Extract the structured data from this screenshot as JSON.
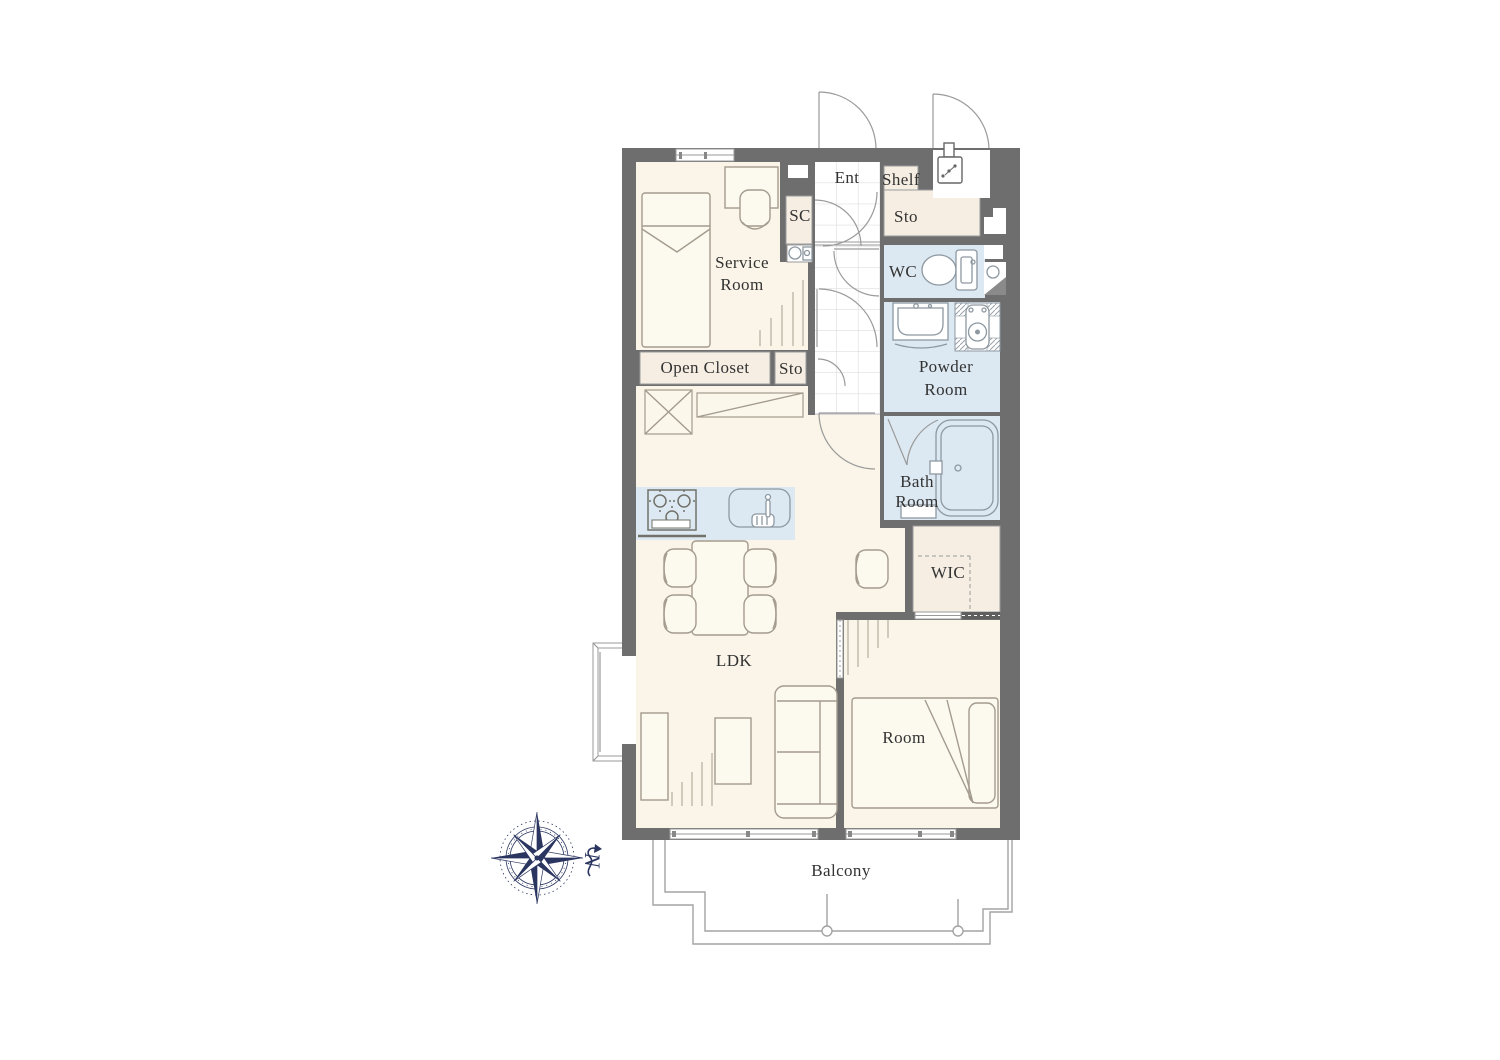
{
  "plan": {
    "labels": {
      "ent": "Ent",
      "shelf": "Shelf",
      "sto_upper": "Sto",
      "sc": "SC",
      "service_room": {
        "line1": "Service",
        "line2": "Room"
      },
      "wc": "WC",
      "powder_room": {
        "line1": "Powder",
        "line2": "Room"
      },
      "open_closet": "Open Closet",
      "sto_lower": "Sto",
      "bath_room": {
        "line1": "Bath",
        "line2": "Room"
      },
      "wic": "WIC",
      "ldk": "LDK",
      "room": "Room",
      "balcony": "Balcony"
    },
    "compass": {
      "north": "N"
    },
    "colors": {
      "wall": "#6e6e6e",
      "floor": "#faf5e8",
      "closet": "#f6eee3",
      "wet_area": "#dde9f2",
      "outline": "#a39b8d",
      "compass": "#2a3560"
    }
  }
}
